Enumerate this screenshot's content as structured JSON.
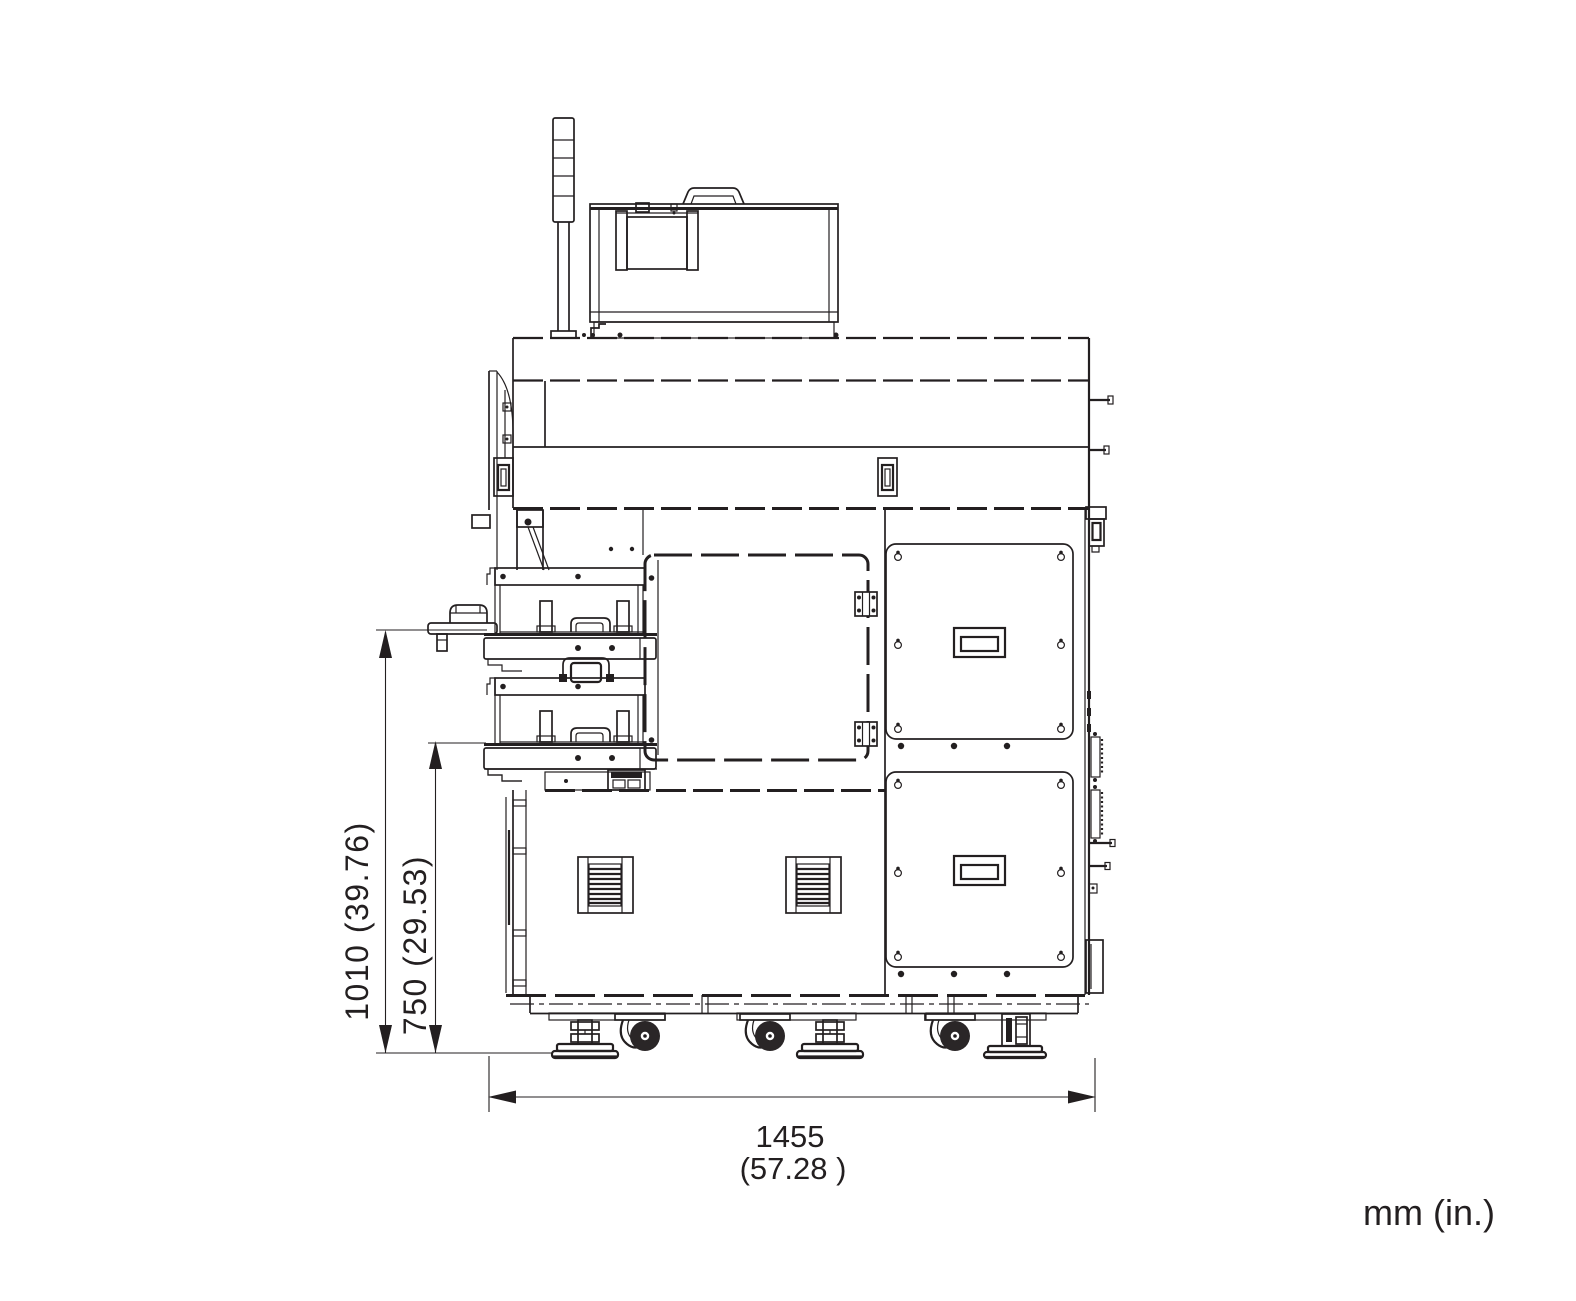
{
  "drawing": {
    "units_note": "mm (in.)",
    "dimensions": {
      "overall_height": {
        "label": "1010 (39.76)",
        "mm": 1010,
        "inches": 39.76
      },
      "partial_height": {
        "label": "750 (29.53)",
        "mm": 750,
        "inches": 29.53
      },
      "overall_width": {
        "value_mm": "1455",
        "value_in": "(57.28  )",
        "mm": 1455,
        "inches": 57.28
      }
    },
    "line_color": "#231f20",
    "background_color": "#ffffff"
  }
}
